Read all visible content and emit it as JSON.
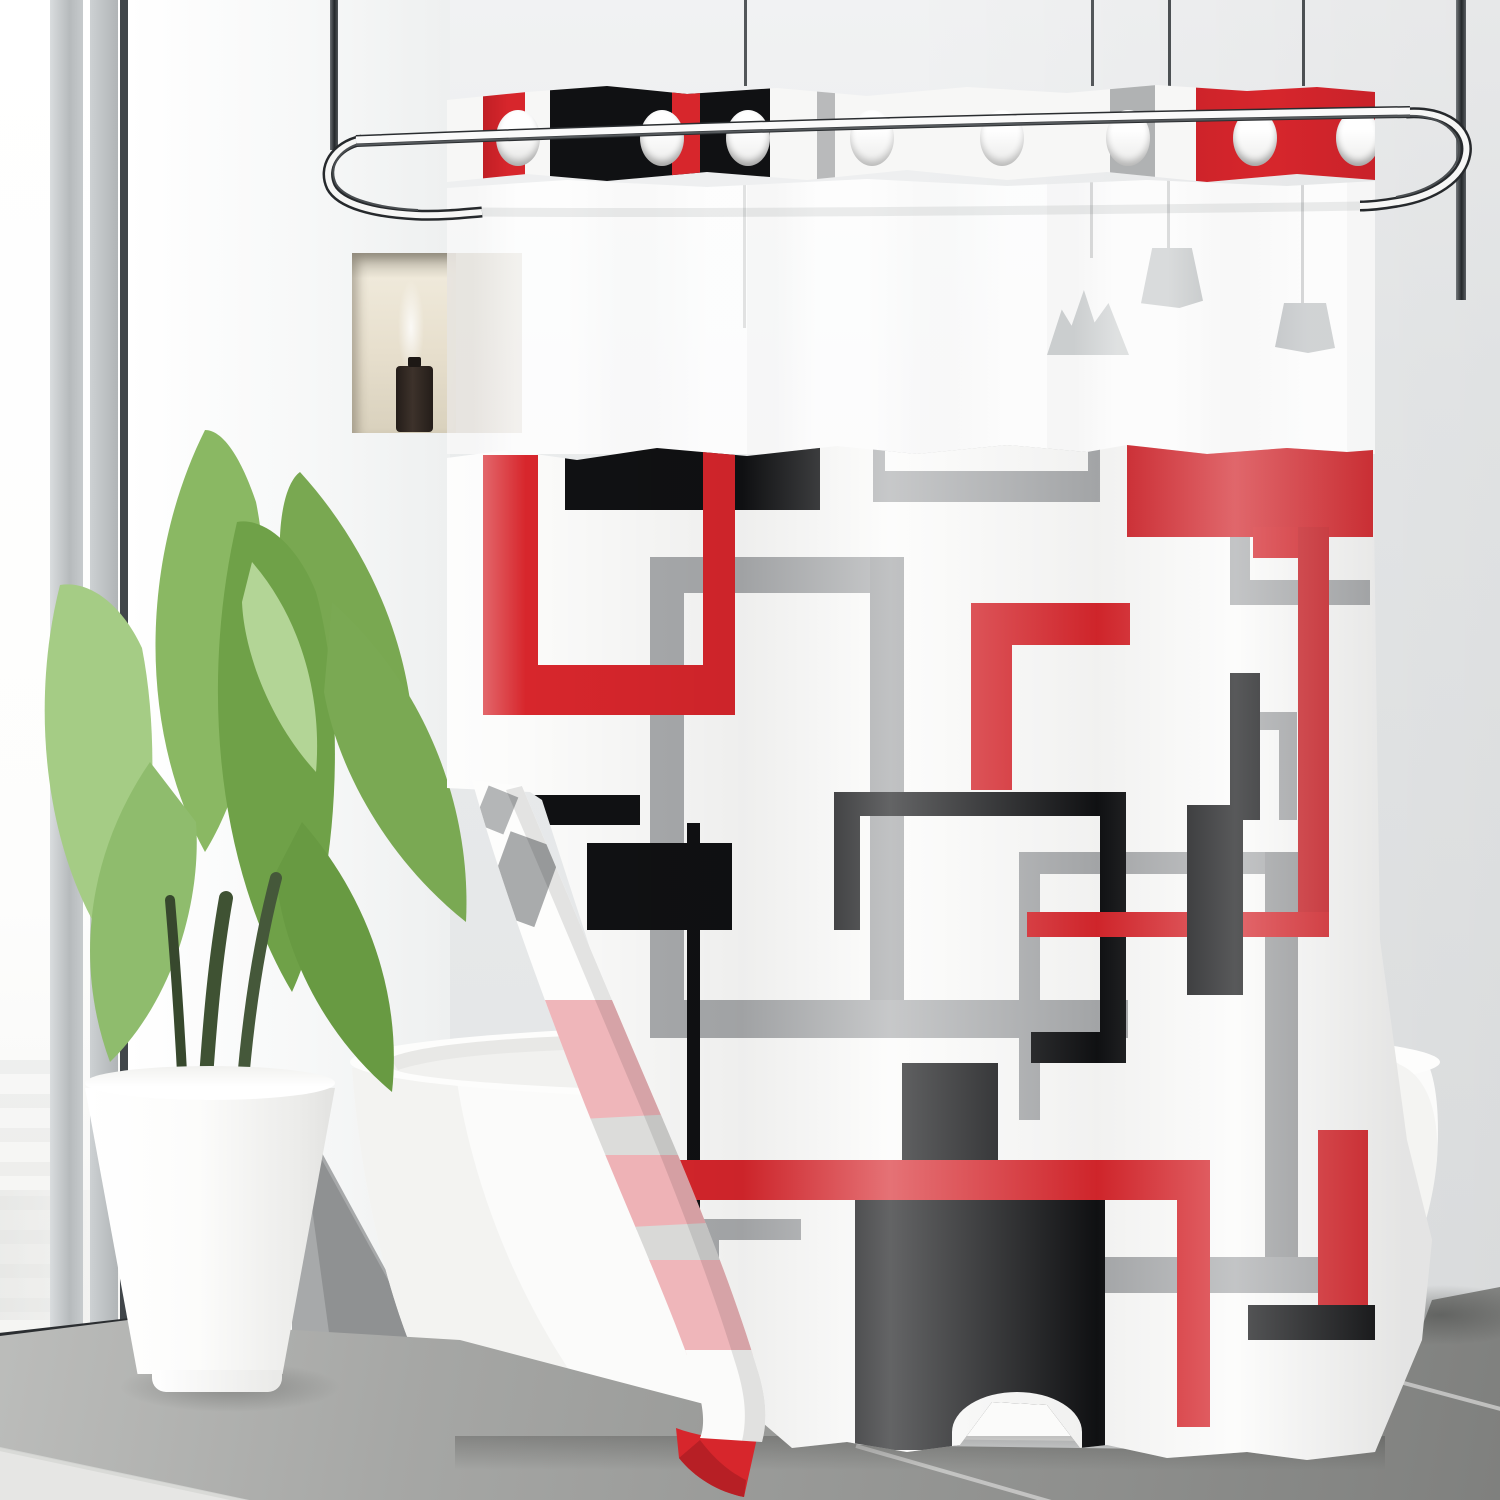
{
  "scene": {
    "description": "Bathroom product photo: white shower curtain with red, black and gray geometric squares pattern hanging from a curved chrome rod; sheer mesh top band, grommet header, flipped corner showing pink back side; green potted plant, white freestanding bathtub, wall niche with dark bottle, pendant lamp silhouettes, gray tile floor, bright window at left",
    "objects": [
      "window",
      "window-frame",
      "wall",
      "wall-niche",
      "diffuser-bottle",
      "ceiling-poles",
      "curved-shower-rod",
      "lamp-cords",
      "pendant-lamps",
      "curtain-grommet-band",
      "curtain-sheer-band",
      "curtain-main-panel",
      "geometric-pattern",
      "flipped-curtain-corner",
      "plant-leaves",
      "white-planter-pot",
      "bathtub",
      "tile-floor"
    ]
  },
  "colors": {
    "red": "#d7262c",
    "red-dark": "#c01f25",
    "pink-back": "#efb6ba",
    "pink-stripe": "#dcdcda",
    "pattern-black": "#101113",
    "pattern-gray": "#a9abad",
    "pattern-gray-light": "#b9babb",
    "curtain-white": "#fbfbfa",
    "sheer-white": "#fdfdfd",
    "wall": "#e8eaeb",
    "wall-bright": "#f6f7f7",
    "niche-warm": "#e9e2d2",
    "bottle-brown": "#362c26",
    "chrome-dark": "#33373a",
    "chrome-light": "#f8f8f8",
    "leaf-green": "#7fb054",
    "leaf-green-dark": "#689a42",
    "leaf-green-light": "#a5cc85",
    "stem-green": "#3f5233",
    "tub-white": "#fcfcfb",
    "floor-gray": "#9b9c9a",
    "floor-dark": "#868785",
    "grout-light": "#d6d7d5",
    "shadow-gray": "#9fa1a2"
  }
}
